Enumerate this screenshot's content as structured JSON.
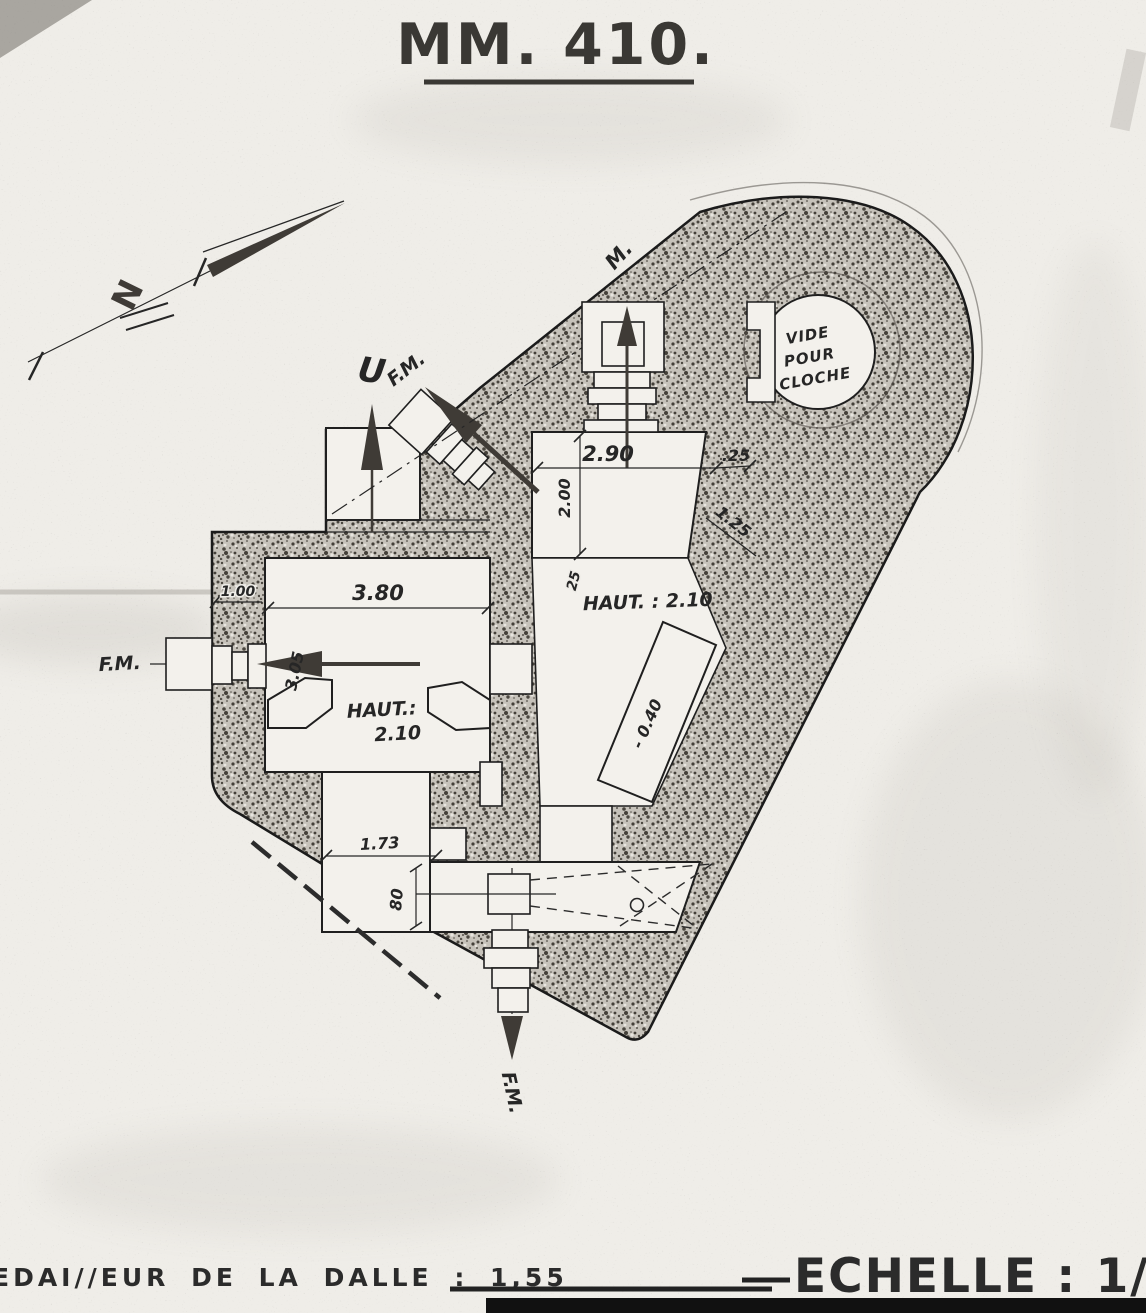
{
  "title": "MM. 410.",
  "footer": {
    "slab": "EDAI//EUR DE LA DALLE : 1,55",
    "scale": "ECHELLE : 1/10"
  },
  "cloche": {
    "line1": "VIDE",
    "line2": "POUR",
    "line3": "CLOCHE"
  },
  "labels": {
    "fm_left": "F.M.",
    "fm_diag": "F.M.",
    "fm_bottom": "F.M.",
    "u_mark": "U",
    "m_mark": "M.",
    "north": "N"
  },
  "dims": {
    "room_right_width": "2.90",
    "wall_top": ".25",
    "room_right_depth": "2.00",
    "wall_diag": "1.25",
    "wall_mid": "25",
    "haut_right": "HAUT. : 2.10",
    "room_left_width": "3.80",
    "wall_left": "1.00",
    "room_left_depth": "3.05",
    "haut_left_1": "HAUT.:",
    "haut_left_2": "2.10",
    "step_down": "- 0.40",
    "passage_width": "1.73",
    "embrasure_width": "80"
  },
  "colors": {
    "paper": "#efede8",
    "ink": "#262626",
    "wall": "#c6c2ba"
  }
}
